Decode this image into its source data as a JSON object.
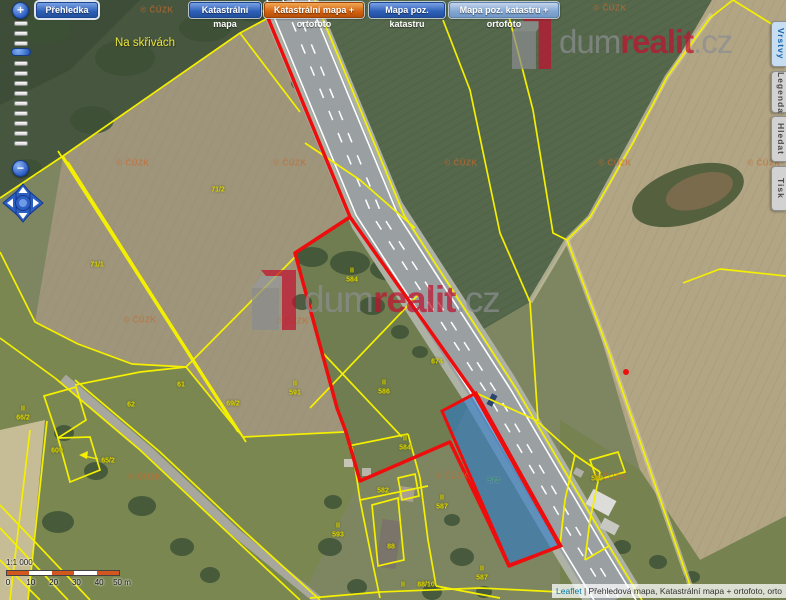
{
  "toolbar": {
    "buttons": [
      {
        "label": "Přehledka",
        "x": 36,
        "w": 62,
        "style": "blue",
        "first": true
      },
      {
        "label": "Katastrální mapa",
        "x": 189,
        "w": 72,
        "style": "blue"
      },
      {
        "label": "Katastrální mapa + ortofoto",
        "x": 264,
        "w": 100,
        "style": "orange"
      },
      {
        "label": "Mapa poz. katastru",
        "x": 369,
        "w": 76,
        "style": "blue"
      },
      {
        "label": "Mapa poz. katastru + ortofoto",
        "x": 449,
        "w": 110,
        "style": "steel"
      }
    ]
  },
  "side_tabs": [
    {
      "label": "Vrstvy",
      "y": 21,
      "h": 46,
      "active": true
    },
    {
      "label": "Legenda",
      "y": 71,
      "h": 42,
      "active": false
    },
    {
      "label": "Hledat",
      "y": 116,
      "h": 46,
      "active": false
    },
    {
      "label": "Tisk",
      "y": 166,
      "h": 45,
      "active": false
    }
  ],
  "zoom_control": {
    "plus": "+",
    "minus": "−",
    "tick_count": 13
  },
  "place_label": {
    "text": "Na skřivách",
    "x": 145,
    "y": 43
  },
  "parcel_labels": [
    {
      "text": "71/2",
      "x": 218,
      "y": 190
    },
    {
      "text": "71/1",
      "x": 97,
      "y": 265
    },
    {
      "text": "61",
      "x": 181,
      "y": 385
    },
    {
      "text": "62",
      "x": 131,
      "y": 405
    },
    {
      "text": "69/2",
      "x": 233,
      "y": 404
    },
    {
      "text": "609",
      "x": 57,
      "y": 451
    },
    {
      "text": "65/2",
      "x": 108,
      "y": 461
    },
    {
      "text": "II",
      "x": 23,
      "y": 409
    },
    {
      "text": "66/2",
      "x": 23,
      "y": 418
    },
    {
      "text": "II",
      "x": 352,
      "y": 271
    },
    {
      "text": "584",
      "x": 352,
      "y": 280
    },
    {
      "text": "II",
      "x": 295,
      "y": 384
    },
    {
      "text": "591",
      "x": 295,
      "y": 393
    },
    {
      "text": "II",
      "x": 384,
      "y": 383
    },
    {
      "text": "586",
      "x": 384,
      "y": 392
    },
    {
      "text": "674",
      "x": 437,
      "y": 362
    },
    {
      "text": "II",
      "x": 405,
      "y": 439
    },
    {
      "text": "584",
      "x": 405,
      "y": 448
    },
    {
      "text": "582",
      "x": 383,
      "y": 491
    },
    {
      "text": "II",
      "x": 442,
      "y": 498
    },
    {
      "text": "587",
      "x": 442,
      "y": 507
    },
    {
      "text": "II",
      "x": 338,
      "y": 526
    },
    {
      "text": "593",
      "x": 338,
      "y": 535
    },
    {
      "text": "88",
      "x": 391,
      "y": 547
    },
    {
      "text": "II",
      "x": 403,
      "y": 585
    },
    {
      "text": "88/10",
      "x": 426,
      "y": 585
    },
    {
      "text": "II",
      "x": 482,
      "y": 569
    },
    {
      "text": "587",
      "x": 482,
      "y": 578
    },
    {
      "text": "589",
      "x": 597,
      "y": 479
    },
    {
      "text": "573",
      "x": 494,
      "y": 481,
      "cls": "teal"
    }
  ],
  "cuzk_watermark": {
    "text": "© ČÚZK",
    "positions": [
      [
        157,
        10
      ],
      [
        610,
        8
      ],
      [
        133,
        163
      ],
      [
        290,
        163
      ],
      [
        461,
        163
      ],
      [
        615,
        163
      ],
      [
        764,
        163
      ],
      [
        140,
        320
      ],
      [
        292,
        321
      ],
      [
        145,
        477
      ],
      [
        452,
        476
      ],
      [
        610,
        477
      ]
    ]
  },
  "logo_watermark": {
    "parts": {
      "p1": "dum",
      "p2": "realit",
      "p3": ".cz"
    },
    "instances": [
      {
        "x": 252,
        "y": 268,
        "scale": 1.0
      },
      {
        "x": 512,
        "y": 14,
        "scale": 0.88
      }
    ]
  },
  "scale_bar": {
    "ratio": "1:1 000",
    "tick_labels": [
      "0",
      "10",
      "20",
      "30",
      "40",
      "50 m"
    ],
    "segment_colors": [
      "#d2571e",
      "#ffffff",
      "#d2571e",
      "#ffffff",
      "#d2571e"
    ]
  },
  "attribution": {
    "link_text": "Leaflet",
    "text": " | Přehledová mapa, Katastrální mapa + ortofoto, orto"
  },
  "geometry": {
    "fields": [
      {
        "n": "meadow-bottom",
        "p": "0,250 35,322 78,344 132,364 186,367 243,437 344,432 360,481 300,600 0,600",
        "c": "#7b8751"
      },
      {
        "n": "forest-top-left",
        "p": "0,0 295,0 268,18 240,33 63,156 0,198",
        "c": "#47573f"
      },
      {
        "n": "forest-top-corner",
        "p": "0,0 140,0 70,70 0,105",
        "c": "#3d4d37"
      },
      {
        "n": "big-tan-field",
        "p": "63,156 240,33 268,18 350,217 295,253 337,408 346,432 243,437 186,367 132,364 78,344 35,322",
        "c": "#9e957b"
      },
      {
        "n": "crop-field",
        "p": "310,0 712,0 667,77 590,217 567,240 530,302 468,338 404,220 377,215 355,140 322,40",
        "c": "#55684c"
      },
      {
        "n": "tan-field-right",
        "p": "712,0 786,0 786,516 700,560 640,470 590,300 567,240 590,217 667,77",
        "c": "#b2a584"
      },
      {
        "n": "grass-bottom-right",
        "p": "560,420 640,470 700,560 786,516 786,600 560,600",
        "c": "#76824f"
      },
      {
        "n": "red-parcel-grass",
        "p": "350,217 474,393 450,442 360,481 346,432 337,408 295,253",
        "c": "#6f7d50"
      },
      {
        "n": "tan-strip-left",
        "p": "0,430 45,420 28,600 0,600",
        "c": "#c6bc95"
      }
    ],
    "textures": [
      {
        "p": "310,0 712,0 667,77 590,217 567,240 530,302 468,338 404,220 377,215 355,140 322,40",
        "pat": "crop",
        "o": 0.45
      },
      {
        "p": "63,156 240,33 268,18 350,217 295,253 337,408 346,432 243,437 186,367 132,364 78,344 35,322",
        "pat": "plow",
        "o": 0.3
      },
      {
        "p": "712,0 786,0 786,516 700,560 640,470 590,300 567,240 590,217 667,77",
        "pat": "plow",
        "o": 0.25
      }
    ],
    "mound": {
      "cx": 688,
      "cy": 195,
      "rx": 58,
      "ry": 28,
      "rot": -18,
      "c1": "#55603f",
      "c2": "#7b6b4d"
    },
    "highway": {
      "center": [
        [
          288,
          0
        ],
        [
          377,
          215
        ],
        [
          490,
          390
        ],
        [
          582,
          546
        ],
        [
          615,
          600
        ]
      ],
      "verge_c": "#adb2a4",
      "asphalt_c": "#9aa0a2"
    },
    "small_road": [
      [
        63,
        378
      ],
      [
        150,
        452
      ],
      [
        235,
        532
      ],
      [
        318,
        600
      ]
    ],
    "dirt_tracks": [
      [
        [
          712,
          14
        ],
        [
          667,
          77
        ],
        [
          590,
          217
        ],
        [
          567,
          240
        ],
        [
          530,
          302
        ]
      ],
      [
        [
          567,
          240
        ],
        [
          610,
          355
        ],
        [
          650,
          470
        ],
        [
          690,
          585
        ]
      ]
    ],
    "trees": [
      [
        45,
        28,
        26,
        16
      ],
      [
        125,
        58,
        30,
        18
      ],
      [
        205,
        28,
        26,
        14
      ],
      [
        92,
        120,
        22,
        14
      ],
      [
        28,
        168,
        14,
        9
      ],
      [
        255,
        12,
        18,
        10
      ],
      [
        300,
        83,
        9,
        7
      ],
      [
        320,
        122,
        6,
        5
      ],
      [
        333,
        153,
        7,
        6
      ],
      [
        341,
        177,
        6,
        5
      ],
      [
        312,
        257,
        16,
        10
      ],
      [
        350,
        263,
        20,
        12
      ],
      [
        392,
        269,
        22,
        12
      ],
      [
        432,
        282,
        15,
        10
      ],
      [
        302,
        302,
        10,
        8
      ],
      [
        372,
        306,
        13,
        9
      ],
      [
        400,
        332,
        9,
        7
      ],
      [
        420,
        352,
        8,
        6
      ],
      [
        64,
        433,
        10,
        8
      ],
      [
        96,
        471,
        12,
        9
      ],
      [
        142,
        506,
        14,
        10
      ],
      [
        58,
        522,
        16,
        11
      ],
      [
        182,
        547,
        12,
        9
      ],
      [
        210,
        575,
        10,
        8
      ],
      [
        333,
        502,
        9,
        7
      ],
      [
        330,
        547,
        12,
        9
      ],
      [
        357,
        587,
        10,
        8
      ],
      [
        452,
        520,
        8,
        6
      ],
      [
        462,
        557,
        12,
        9
      ],
      [
        432,
        592,
        10,
        8
      ],
      [
        484,
        592,
        8,
        6
      ],
      [
        622,
        547,
        9,
        7
      ],
      [
        658,
        562,
        9,
        7
      ],
      [
        692,
        577,
        8,
        6
      ],
      [
        560,
        480,
        7,
        6
      ]
    ],
    "buildings": [
      [
        379,
        520,
        20,
        48,
        8,
        "#7a746b"
      ],
      [
        399,
        487,
        15,
        14,
        8,
        "#a89f90"
      ],
      [
        362,
        468,
        9,
        8,
        0,
        "#b9b4aa"
      ],
      [
        344,
        459,
        9,
        8,
        0,
        "#c8c4b8"
      ],
      [
        588,
        494,
        26,
        17,
        28,
        "#dcdcd8"
      ],
      [
        601,
        521,
        17,
        11,
        28,
        "#c8c8c2"
      ],
      [
        574,
        469,
        9,
        7,
        28,
        "#b0b0a8"
      ],
      [
        489,
        394,
        6,
        12,
        28,
        "#2b4470"
      ]
    ],
    "yellow_lines": [
      [
        [
          0,
          198
        ],
        [
          63,
          156
        ]
      ],
      [
        [
          63,
          156
        ],
        [
          240,
          33
        ],
        [
          268,
          18
        ]
      ],
      [
        [
          63,
          156
        ],
        [
          243,
          437
        ]
      ],
      [
        [
          68,
          162
        ],
        [
          246,
          442
        ]
      ],
      [
        [
          58,
          151
        ],
        [
          238,
          432
        ]
      ],
      [
        [
          240,
          33
        ],
        [
          300,
          112
        ]
      ],
      [
        [
          0,
          252
        ],
        [
          35,
          322
        ],
        [
          78,
          344
        ],
        [
          132,
          364
        ],
        [
          186,
          367
        ],
        [
          296,
          256
        ]
      ],
      [
        [
          186,
          367
        ],
        [
          243,
          437
        ]
      ],
      [
        [
          243,
          437
        ],
        [
          344,
          432
        ]
      ],
      [
        [
          55,
          378
        ],
        [
          140,
          450
        ],
        [
          225,
          530
        ],
        [
          300,
          600
        ]
      ],
      [
        [
          75,
          380
        ],
        [
          160,
          452
        ],
        [
          245,
          532
        ],
        [
          320,
          600
        ]
      ],
      [
        [
          0,
          338
        ],
        [
          55,
          378
        ]
      ],
      [
        [
          75,
          385
        ],
        [
          140,
          372
        ],
        [
          186,
          367
        ]
      ],
      [
        [
          0,
          505
        ],
        [
          90,
          600
        ]
      ],
      [
        [
          0,
          528
        ],
        [
          68,
          600
        ]
      ],
      [
        [
          0,
          560
        ],
        [
          40,
          600
        ]
      ],
      [
        [
          30,
          430
        ],
        [
          10,
          600
        ]
      ],
      [
        [
          47,
          421
        ],
        [
          28,
          600
        ]
      ],
      [
        [
          310,
          408
        ],
        [
          418,
          295
        ]
      ],
      [
        [
          320,
          350
        ],
        [
          402,
          437
        ]
      ],
      [
        [
          305,
          143
        ],
        [
          360,
          180
        ],
        [
          415,
          228
        ]
      ],
      [
        [
          476,
          393
        ],
        [
          538,
          421
        ]
      ],
      [
        [
          315,
          0
        ],
        [
          404,
          215
        ],
        [
          517,
          390
        ],
        [
          609,
          546
        ],
        [
          642,
          600
        ]
      ],
      [
        [
          443,
          20
        ],
        [
          470,
          90
        ],
        [
          500,
          233
        ],
        [
          530,
          302
        ],
        [
          538,
          421
        ]
      ],
      [
        [
          508,
          13
        ],
        [
          533,
          110
        ],
        [
          553,
          233
        ],
        [
          567,
          240
        ]
      ],
      [
        [
          733,
          0
        ],
        [
          710,
          18
        ],
        [
          667,
          77
        ],
        [
          633,
          143
        ],
        [
          590,
          217
        ],
        [
          567,
          240
        ]
      ],
      [
        [
          733,
          0
        ],
        [
          786,
          33
        ]
      ],
      [
        [
          567,
          240
        ],
        [
          610,
          355
        ],
        [
          650,
          470
        ],
        [
          690,
          585
        ]
      ],
      [
        [
          683,
          283
        ],
        [
          720,
          269
        ],
        [
          786,
          276
        ]
      ],
      [
        [
          538,
          422
        ],
        [
          575,
          455
        ],
        [
          600,
          472
        ]
      ],
      [
        [
          600,
          472
        ],
        [
          590,
          520
        ],
        [
          585,
          560
        ]
      ],
      [
        [
          575,
          455
        ],
        [
          565,
          500
        ],
        [
          560,
          545
        ]
      ],
      [
        [
          585,
          560
        ],
        [
          609,
          546
        ]
      ],
      [
        [
          348,
          446
        ],
        [
          408,
          434
        ]
      ],
      [
        [
          408,
          434
        ],
        [
          420,
          478
        ]
      ],
      [
        [
          352,
          447
        ],
        [
          360,
          500
        ],
        [
          372,
          560
        ],
        [
          380,
          598
        ]
      ],
      [
        [
          420,
          478
        ],
        [
          428,
          540
        ],
        [
          436,
          586
        ]
      ],
      [
        [
          360,
          500
        ],
        [
          428,
          486
        ]
      ],
      [
        [
          436,
          586
        ],
        [
          500,
          598
        ]
      ],
      [
        [
          310,
          598
        ],
        [
          380,
          592
        ],
        [
          480,
          588
        ],
        [
          560,
          592
        ]
      ]
    ],
    "yellow_polys": [
      "44,396 76,387 86,420 58,438",
      "58,438 90,437 100,470 70,482",
      "590,460 618,452 625,472 597,480",
      "372,505 398,498 404,560 378,566",
      "398,478 415,474 419,496 402,500"
    ],
    "arrow": {
      "line": [
        [
          98,
          459
        ],
        [
          84,
          456
        ]
      ],
      "head": "79,455 88,451 87,459"
    },
    "red_path": "M268,18 L350,217 L295,253 L337,408 L346,432 L360,481 L450,442 L488,521 L509,566 L560,546 L474,393 L350,217 Z",
    "blue_parcel": "476,393 442,411 509,565 561,546",
    "red_dot": [
      626,
      372
    ],
    "colors": {
      "yellow": "#f4f000",
      "red": "#ee0d0d",
      "blue_fill": "rgba(40,120,205,0.58)"
    }
  }
}
